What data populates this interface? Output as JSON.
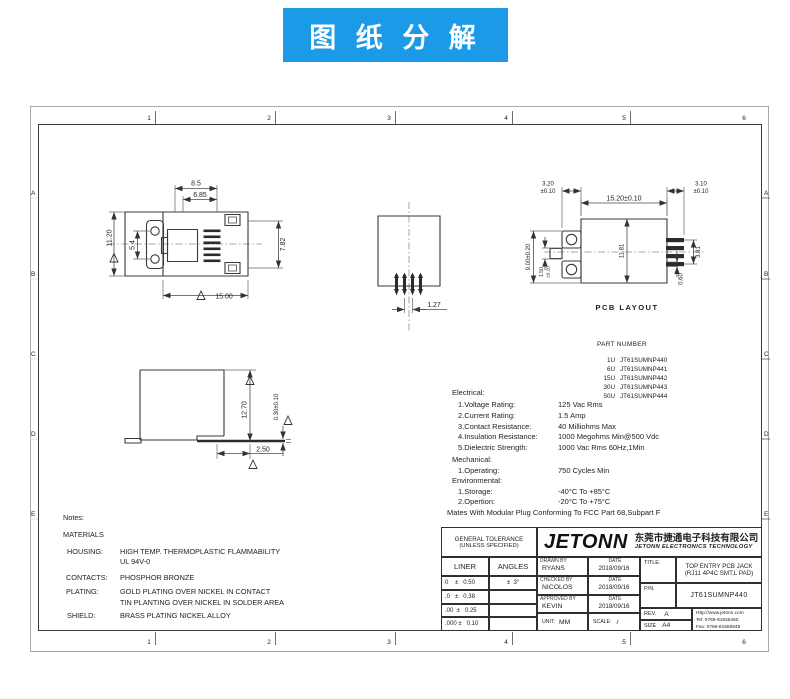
{
  "banner": {
    "text": "图 纸 分 解"
  },
  "frame": {
    "top_zone_numbers": [
      "1",
      "2",
      "3",
      "4",
      "5",
      "6"
    ],
    "bottom_zone_numbers": [
      "1",
      "2",
      "3",
      "4",
      "5",
      "6"
    ],
    "left_zone_letters": [
      "A",
      "B",
      "C",
      "D",
      "E"
    ],
    "right_zone_letters": [
      "A",
      "B",
      "C",
      "D",
      "E"
    ]
  },
  "front_view": {
    "dim_8_5": "8.5",
    "dim_6_85": "6.85",
    "dim_11_20": "11.20",
    "dim_5_4": "5.4",
    "dim_7_82": "7.82",
    "dim_15_00": "15.00"
  },
  "section_view": {
    "dim_1_27": "1.27"
  },
  "pcb_view": {
    "label": "PCB  LAYOUT",
    "dim_3_20": "3.20",
    "tol_3_20": "±0.10",
    "dim_15_20": "15.20±0.10",
    "dim_3_10": "3.10",
    "tol_3_10": "±0.10",
    "dim_9_00": "9.00±0.20",
    "dim_1_50": "1.50",
    "tol_1_50": "±0.20",
    "dim_11_81": "11.81",
    "dim_3_81": "3.81",
    "dim_0_60": "0.60"
  },
  "side_view": {
    "dim_12_70": "12.70",
    "dim_0_30": "0.30±0.10",
    "dim_2_50": "2.50"
  },
  "part_numbers": {
    "title": "PART NUMBER",
    "rows": [
      {
        "code": "1U",
        "pn": "JT61SUMNP440"
      },
      {
        "code": "6U",
        "pn": "JT61SUMNP441"
      },
      {
        "code": "15U",
        "pn": "JT61SUMNP442"
      },
      {
        "code": "30U",
        "pn": "JT61SUMNP443"
      },
      {
        "code": "50U",
        "pn": "JT61SUMNP444"
      }
    ]
  },
  "specs": {
    "electrical_header": "Electrical:",
    "electrical": [
      {
        "label": "1.Voltage Rating:",
        "value": "125 Vac Rms"
      },
      {
        "label": "2.Current Rating:",
        "value": "1.5 Amp"
      },
      {
        "label": "3.Contact Resistance:",
        "value": "40 Milliohms Max"
      },
      {
        "label": "4.Insulation Resistance:",
        "value": "1000 Megohms Min@500 Vdc"
      },
      {
        "label": "5.Dielectric Strength:",
        "value": "1000 Vac Rms 60Hz,1Min"
      }
    ],
    "mechanical_header": "Mechanical:",
    "mechanical": [
      {
        "label": "1.Operating:",
        "value": "750 Cycles Min"
      }
    ],
    "environmental_header": "Environmental:",
    "environmental": [
      {
        "label": "1.Storage:",
        "value": "-40°C To +85°C"
      },
      {
        "label": "2.Opertion:",
        "value": "-20°C To +75°C"
      }
    ],
    "mates_note": "Mates With Modular Plug Conforming To FCC Part 68,Subpart F"
  },
  "notes": {
    "header": "Notes:",
    "materials_header": "MATERIALS",
    "housing_label": "HOUSING:",
    "housing_line1": "HIGH TEMP. THERMOPLASTIC FLAMMABILITY",
    "housing_line2": "UL 94V-0",
    "contacts_label": "CONTACTS:",
    "contacts_line1": "PHOSPHOR BRONZE",
    "plating_label": "PLATING:",
    "plating_line1": "GOLD PLATING OVER NICKEL IN CONTACT",
    "plating_line2": "TIN PLANTING OVER NICKEL IN SOLDER AREA",
    "shield_label": "SHIELD:",
    "shield_line1": "BRASS PLATING NICKEL ALLOY"
  },
  "title_block": {
    "general_tolerance_line1": "GENERAL TOLERANCE",
    "general_tolerance_line2": "(UNLESS SPECIFIED)",
    "liner_header": "LINER",
    "angles_header": "ANGLES",
    "tol_row1_liner": "0    ±   0.50",
    "tol_row1_angles": "±  3°",
    "tol_row2_liner": ".0   ±   0.38",
    "tol_row3_liner": ".00  ±   0.25",
    "tol_row4_liner": ".000 ±   0.10",
    "logo_text": "JETONN",
    "company_cn": "东莞市捷通电子科技有限公司",
    "company_en": "JETONN ELECTRONICS TECHNOLOGY",
    "drawn_by_label": "DRAWN BY",
    "drawn_by": "RYANS",
    "checked_by_label": "CHECKED BY",
    "checked_by": "NICOLOS",
    "approved_by_label": "APPROVED BY",
    "approved_by": "KEVIN",
    "date_label": "DATE",
    "drawn_date": "2018/09/16",
    "checked_date": "2018/09/16",
    "approved_date": "2018/09/16",
    "unit_label": "UNIT:",
    "unit_value": "MM",
    "scale_label": "SCALE:",
    "scale_value": "/",
    "title_label": "TITLE.",
    "title_line1": "TOP ENTRY PCB JACK",
    "title_line2": "(RJ11 4P4C SMT,L PAD)",
    "pn_label": "P/N.",
    "pn_value": "JT61SUMNP440",
    "rev_label": "REV.",
    "rev_value": "A",
    "size_label": "SIZE",
    "size_value": "A4",
    "website": "Http://www.jetonn.com",
    "tel": "Tel:  0769-81555450",
    "fax": "Fax: 0769-81555945"
  }
}
